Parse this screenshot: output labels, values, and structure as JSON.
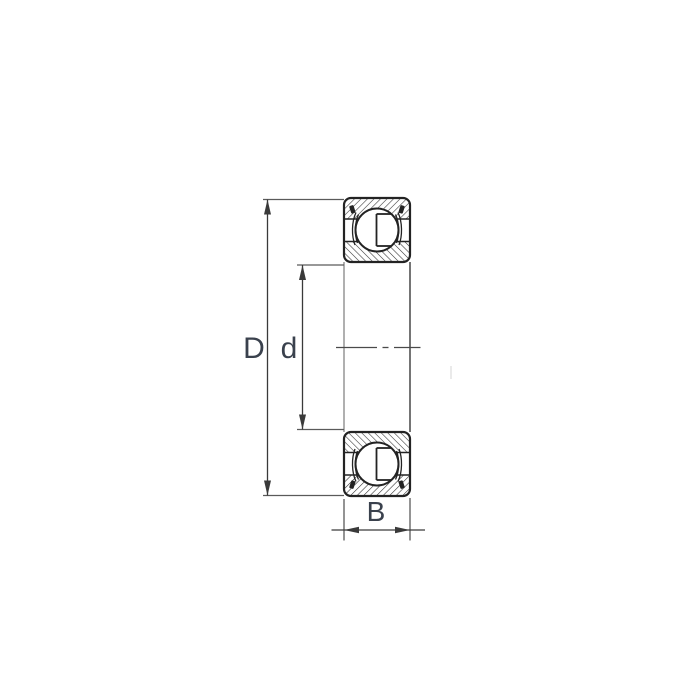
{
  "diagram": {
    "type": "ball-bearing-cross-section-drawing",
    "labels": {
      "outer_diameter": "D",
      "bore_diameter": "d",
      "width": "B"
    },
    "colors": {
      "background": "#ffffff",
      "outline": "#232323",
      "hatch": "#2d2d2d",
      "dimension_line": "#5a5a5a",
      "arrow": "#3a3a3a",
      "centerline": "#4a4a4a",
      "bore_line_light": "#8f8f8f",
      "label_text": "#3a414d"
    }
  }
}
